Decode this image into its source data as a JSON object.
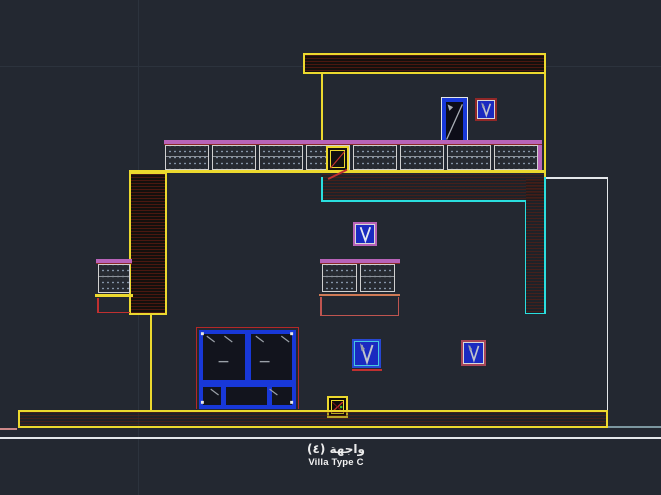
{
  "titles": {
    "facade_ar": "واجهة (٤)",
    "villa_type": "Villa Type C"
  },
  "colors": {
    "bg": "#232831",
    "grid": "#2c333d",
    "yellow": "#ecd92e",
    "cyan": "#2adede",
    "magenta": "#b863b8",
    "red": "#b42828",
    "red-bright": "#c03030",
    "blue": "#1838d8",
    "blue-fill": "#1a2ac0",
    "white-line": "#e4e7ea",
    "panel-border": "#d0d0d0",
    "orange": "#cf7a55",
    "salmon": "#c05550",
    "pink": "#cc8888"
  },
  "icons": {
    "vent_symbol": "V-arrow-down",
    "door_symbol": "diagonal-swing-line",
    "drain_box_symbol": "crossed-box-with-green-dot"
  }
}
